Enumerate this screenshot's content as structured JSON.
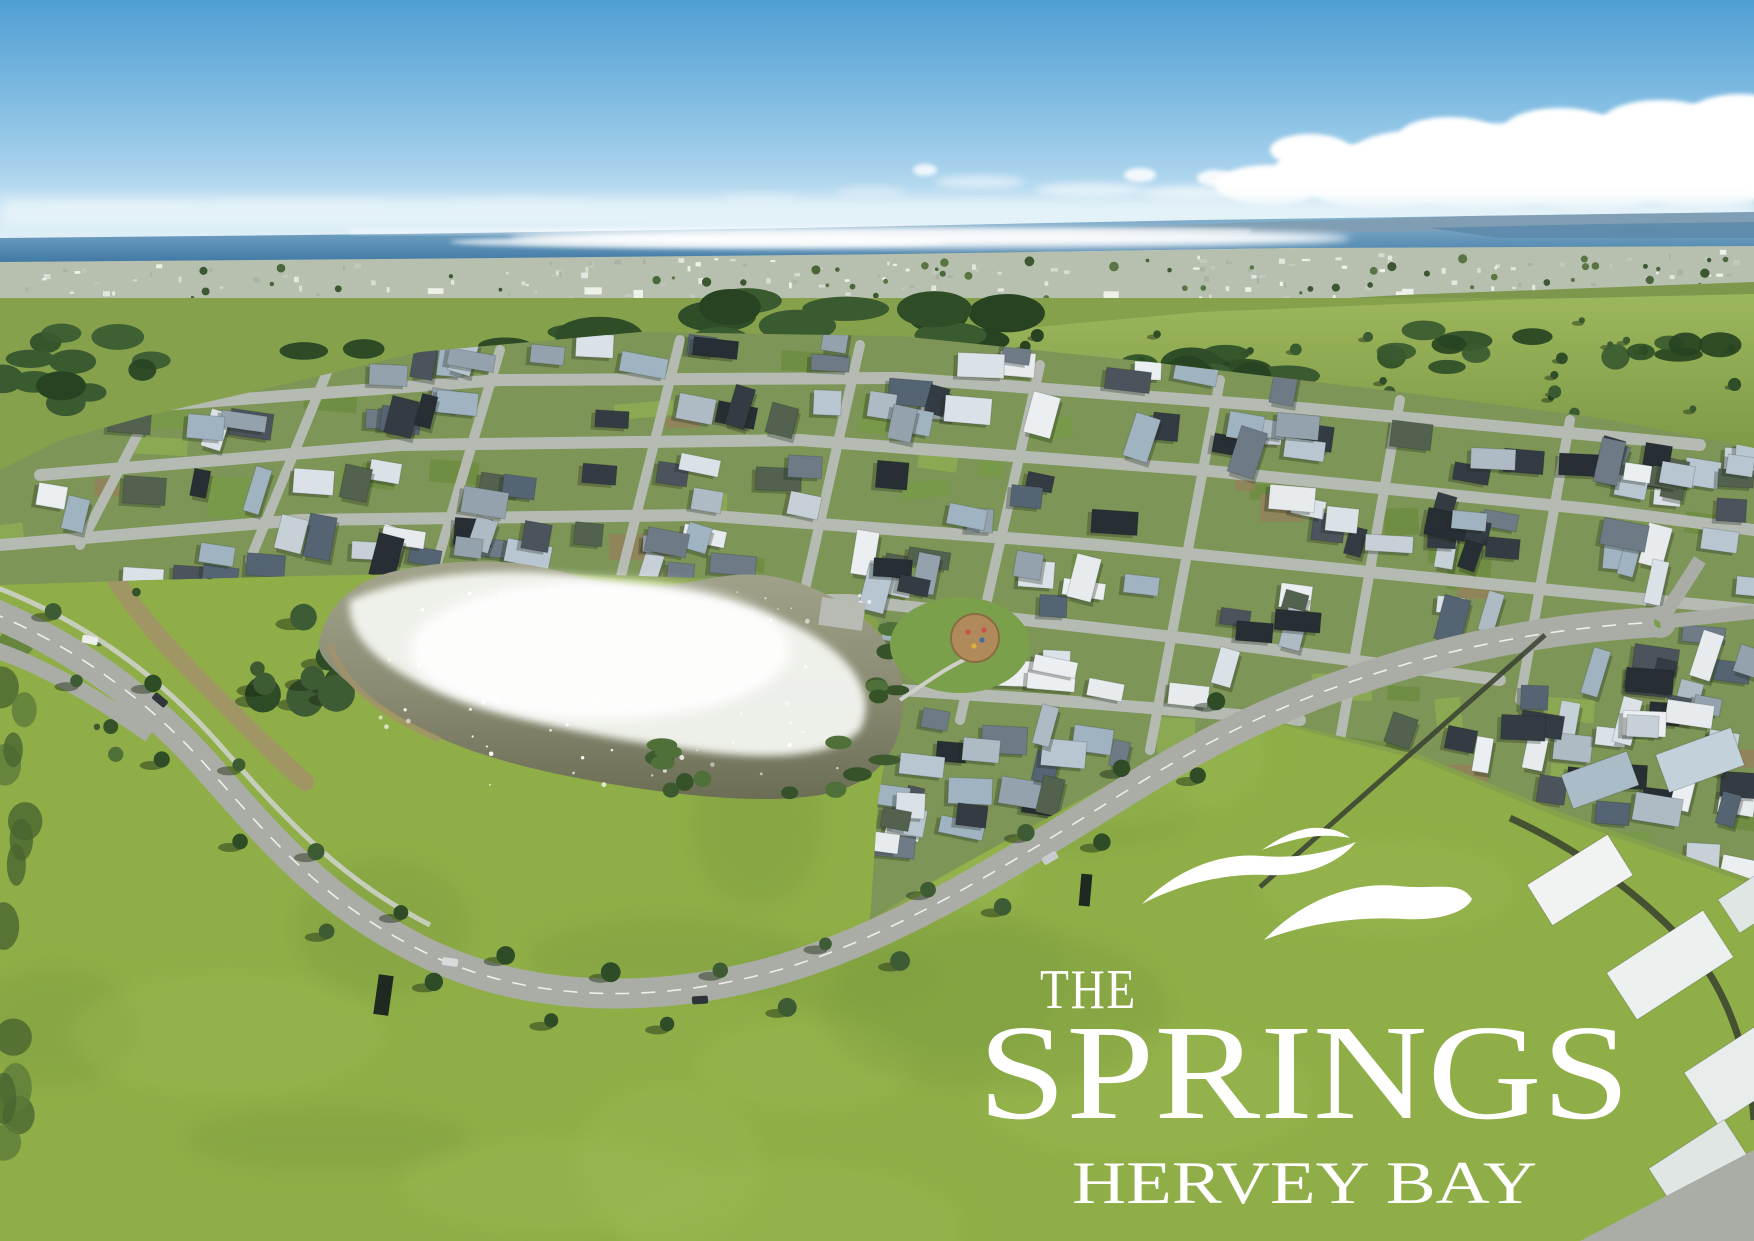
{
  "page": {
    "description": "Aerial drone photograph of The Springs residential estate at Hervey Bay: blue sky with a cloud bank, ocean horizon with sun glitter, distant coastal town, a large new housing estate with grey and white rooftops, a sparkling lake, a curving boulevard lined with trees, and bright green parkland carrying the white estate logo."
  },
  "logo": {
    "the": "THE",
    "title": "SPRINGS",
    "subtitle": "HERVEY BAY",
    "color": "#ffffff",
    "icon": "triple-wave-swoosh"
  },
  "palette": {
    "sky_top": "#4f9fd3",
    "sky_mid": "#7ab8e0",
    "sky_low": "#a8d2ec",
    "sky_horizon": "#e8f4f9",
    "cloud": "#ffffff",
    "cloud_shadow": "#c3d2da",
    "ocean_top": "#8fb8d2",
    "ocean_bottom": "#417aa6",
    "headland": "#7f9db2",
    "headland_near": "#5e8aab",
    "sun_glitter": "#ffffff",
    "town_base": "#b7c0ae",
    "town_specks": [
      "#eef0ea",
      "#d8dcd4",
      "#c2c8be",
      "#aab2a4",
      "#e4e7e0"
    ],
    "town_trees": [
      "#4a663b",
      "#3c5731",
      "#5a7544"
    ],
    "forest": [
      "#2f4e28",
      "#3a5a30",
      "#274322"
    ],
    "hill_light": "#9cb75b",
    "hill_dark": "#7e9a48",
    "land_base": "#86a14c",
    "field": "#8fae47",
    "field_light": "#9cbb55",
    "field_dark": "#7d9c3f",
    "estate_base": "#7d9557",
    "street": "#b5bab2",
    "roof_colors": [
      "#eceff1",
      "#dbe2e7",
      "#c6d0d7",
      "#aebbc4",
      "#93a2ad",
      "#6e7b86",
      "#4b545c",
      "#343c43",
      "#272e34",
      "#b8c6d1",
      "#9fb3c0",
      "#556472",
      "#e7ebed",
      "#52624f"
    ],
    "lawn_patches": [
      "#789a47",
      "#6b8c3e",
      "#8fae52"
    ],
    "dirt": "#97805b",
    "lake_top": "#a3a48c",
    "lake_mid": "#8a8b72",
    "lake_bottom": "#6b6d54",
    "glitter": "#f2f4ef",
    "sand": "#a3926a",
    "vegetation": [
      "#3c5a2e",
      "#4f7038",
      "#355229"
    ],
    "road": "#a9ada5",
    "road_line": "#ffffff",
    "footpath": "#cdd0c8",
    "tree": "#2e4c26",
    "tree_light": "#3d5c33",
    "tree_shadow": "rgba(25,40,18,0.45)",
    "scrub": [
      "#5d7a3a",
      "#4a6530"
    ],
    "playground_sand": "#b08a5a",
    "court": "#b7bbb3",
    "industrial_roofs": [
      "#f0f3f2",
      "#ecf0ee",
      "#e8edec",
      "#dfe6e4",
      "#c3d2da",
      "#a9bcc8"
    ],
    "hedge": "#3e472f",
    "fence": "#394031",
    "car_colors": [
      "#eceeee",
      "#30363c",
      "#d8dadb",
      "#2e3338",
      "#c9ccce"
    ],
    "sign": "#1e2a20"
  },
  "counts": {
    "houses": 250,
    "town_specks": 170,
    "town_trees": 70,
    "glitter_specks": 90,
    "field_mottles": 18,
    "hill_trees": 26
  }
}
